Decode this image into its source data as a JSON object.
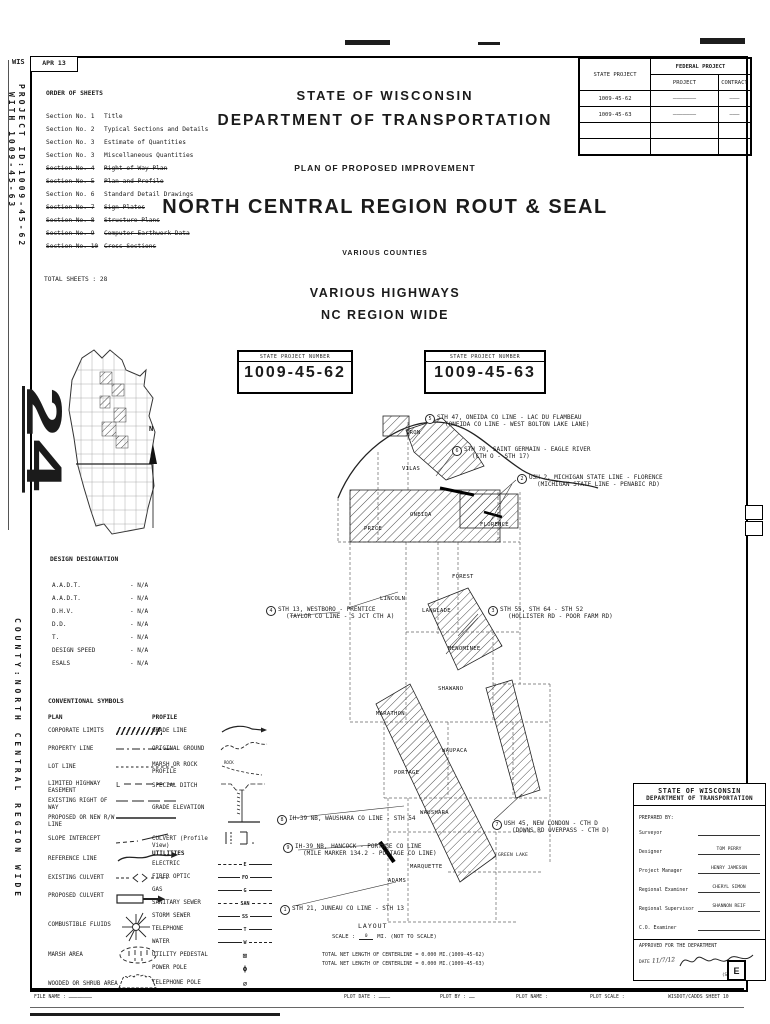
{
  "stamp": {
    "wis": "WIS",
    "date": "APR 13"
  },
  "margin_notes": {
    "project_id_1": "PROJECT ID:1009-45-62",
    "project_id_2": "WITH 1009-45-63",
    "county": "COUNTY:NORTH CENTRAL REGION WIDE"
  },
  "order_of_sheets": {
    "title": "ORDER OF SHEETS",
    "items": [
      {
        "no": "Section No. 1",
        "desc": "Title"
      },
      {
        "no": "Section No. 2",
        "desc": "Typical Sections and Details"
      },
      {
        "no": "Section No. 3",
        "desc": "Estimate of Quantities"
      },
      {
        "no": "Section No. 3",
        "desc": "Miscellaneous Quantities"
      },
      {
        "no": "Section No. 4",
        "desc": "Right of Way Plan"
      },
      {
        "no": "Section No. 5",
        "desc": "Plan and Profile"
      },
      {
        "no": "Section No. 6",
        "desc": "Standard Detail Drawings"
      },
      {
        "no": "Section No. 7",
        "desc": "Sign Plates"
      },
      {
        "no": "Section No. 8",
        "desc": "Structure Plans"
      },
      {
        "no": "Section No. 9",
        "desc": "Computer Earthwork Data"
      },
      {
        "no": "Section No. 10",
        "desc": "Cross Sections"
      }
    ],
    "total": "TOTAL SHEETS : 28"
  },
  "header": {
    "state": "STATE OF WISCONSIN",
    "dept": "DEPARTMENT OF TRANSPORTATION",
    "plan": "PLAN OF PROPOSED IMPROVEMENT",
    "project_title": "NORTH CENTRAL REGION ROUT & SEAL",
    "counties": "VARIOUS COUNTIES",
    "highways": "VARIOUS HIGHWAYS",
    "region": "NC REGION WIDE"
  },
  "project_table": {
    "state_project": "STATE PROJECT",
    "federal_project": "FEDERAL PROJECT",
    "project": "PROJECT",
    "contract": "CONTRACT",
    "rows": [
      {
        "state": "1009-45-62",
        "project": "———————",
        "contract": "———"
      },
      {
        "state": "1009-45-63",
        "project": "———————",
        "contract": "———"
      },
      {
        "state": "",
        "project": "",
        "contract": ""
      },
      {
        "state": "",
        "project": "",
        "contract": ""
      }
    ]
  },
  "project_boxes": [
    {
      "label": "STATE PROJECT NUMBER",
      "number": "1009-45-62"
    },
    {
      "label": "STATE PROJECT NUMBER",
      "number": "1009-45-63"
    }
  ],
  "state_map": {
    "sheet_number": "24",
    "north": "N"
  },
  "design_designation": {
    "title": "DESIGN DESIGNATION",
    "rows": [
      {
        "label": "A.A.D.T.",
        "value": "N/A"
      },
      {
        "label": "A.A.D.T.",
        "value": "N/A"
      },
      {
        "label": "D.H.V.",
        "value": "N/A"
      },
      {
        "label": "D.D.",
        "value": "N/A"
      },
      {
        "label": "T.",
        "value": "N/A"
      },
      {
        "label": "DESIGN SPEED",
        "value": "N/A"
      },
      {
        "label": "ESALS",
        "value": "N/A"
      }
    ]
  },
  "symbols": {
    "title": "CONVENTIONAL SYMBOLS",
    "plan_title": "PLAN",
    "plan": [
      {
        "label": "CORPORATE LIMITS"
      },
      {
        "label": "PROPERTY LINE"
      },
      {
        "label": "LOT LINE"
      },
      {
        "label": "LIMITED HIGHWAY EASEMENT"
      },
      {
        "label": "EXISTING RIGHT OF WAY"
      },
      {
        "label": "PROPOSED OR NEW R/W LINE"
      },
      {
        "label": "SLOPE INTERCEPT"
      },
      {
        "label": "REFERENCE LINE"
      },
      {
        "label": "EXISTING CULVERT"
      },
      {
        "label": "PROPOSED CULVERT",
        "note": "(Box or Pipe)"
      },
      {
        "label": "COMBUSTIBLE FLUIDS"
      },
      {
        "label": "MARSH AREA"
      },
      {
        "label": "WOODED OR SHRUB AREA"
      }
    ],
    "profile_title": "PROFILE",
    "rock_label": "ROCK",
    "profile": [
      {
        "label": "GRADE LINE"
      },
      {
        "label": "ORIGINAL GROUND"
      },
      {
        "label": "MARSH OR ROCK PROFILE",
        "note": "(To be noted as such)"
      },
      {
        "label": "SPECIAL DITCH"
      },
      {
        "label": "GRADE ELEVATION"
      },
      {
        "label": "CULVERT (Profile View)"
      }
    ],
    "utilities_title": "UTILITIES",
    "utilities": [
      {
        "label": "ELECTRIC",
        "code": "E"
      },
      {
        "label": "FIBER OPTIC",
        "code": "FO"
      },
      {
        "label": "GAS",
        "code": "G"
      },
      {
        "label": "SANITARY SEWER",
        "code": "SAN"
      },
      {
        "label": "STORM SEWER",
        "code": "SS"
      },
      {
        "label": "TELEPHONE",
        "code": "T"
      },
      {
        "label": "WATER",
        "code": "W"
      },
      {
        "label": "UTILITY PEDESTAL",
        "code": "⊠"
      },
      {
        "label": "POWER POLE",
        "code": "ϕ"
      },
      {
        "label": "TELEPHONE POLE",
        "code": "∅"
      }
    ]
  },
  "map": {
    "counties": [
      "IRON",
      "VILAS",
      "PRICE",
      "ONEIDA",
      "FLORENCE",
      "FOREST",
      "LINCOLN",
      "LANGLADE",
      "MENOMINEE",
      "SHAWANO",
      "MARATHON",
      "WAUPACA",
      "PORTAGE",
      "WAUSHARA",
      "GREEN LAKE",
      "MARQUETTE",
      "ADAMS"
    ],
    "callouts": [
      {
        "num": "1",
        "line1": "STH 21, JUNEAU CO LINE - STH 13",
        "line2": ""
      },
      {
        "num": "2",
        "line1": "USH 2, MICHIGAN STATE LINE - FLORENCE",
        "line2": "(MICHIGAN STATE LINE - PENABIC RD)"
      },
      {
        "num": "3",
        "line1": "STH 55, STH 64 - STH 52",
        "line2": "(HOLLISTER RD - POOR FARM RD)"
      },
      {
        "num": "4",
        "line1": "STH 13, WESTBORO - PRENTICE",
        "line2": "(TAYLOR CO LINE - S JCT CTH A)"
      },
      {
        "num": "5",
        "line1": "STH 47, ONEIDA CO LINE - LAC DU FLAMBEAU",
        "line2": "(ONEIDA CO LINE - WEST BOLTON LAKE LANE)"
      },
      {
        "num": "6",
        "line1": "STH 70, SAINT GERMAIN - EAGLE RIVER",
        "line2": "(CTH O - STH 17)"
      },
      {
        "num": "7",
        "line1": "USH 45, NEW LONDON - CTH D",
        "line2": "(DOWNS RD OVERPASS - CTH D)"
      },
      {
        "num": "8",
        "line1": "IH-39 NB, WAUSHARA CO LINE - STH 54",
        "line2": ""
      },
      {
        "num": "9",
        "line1": "IH-39 NB, HANCOCK - PORTAGE CO LINE",
        "line2": "(MILE MARKER 134.2 - PORTAGE CO LINE)"
      }
    ]
  },
  "layout_block": {
    "title": "LAYOUT",
    "scale_label": "SCALE :",
    "scale_zero": "0",
    "scale_note": "MI. (NOT TO SCALE)",
    "total_1": "TOTAL NET LENGTH OF CENTERLINE = 0.000 MI.(1009-45-62)",
    "total_2": "TOTAL NET LENGTH OF CENTERLINE = 0.000 MI.(1009-45-63)"
  },
  "prepared_box": {
    "state": "STATE OF WISCONSIN",
    "dept": "DEPARTMENT OF TRANSPORTATION",
    "prepared_by": "PREPARED BY:",
    "rows": [
      {
        "label": "Surveyor",
        "value": ""
      },
      {
        "label": "Designer",
        "value": "TOM PERRY"
      },
      {
        "label": "Project Manager",
        "value": "HENRY JAMESON"
      },
      {
        "label": "Regional Examiner",
        "value": "CHERYL SIMON"
      },
      {
        "label": "Regional Supervisor",
        "value": "SHANNON REIF"
      },
      {
        "label": "C.O. Examiner",
        "value": ""
      }
    ],
    "approved": "APPROVED FOR THE DEPARTMENT",
    "date_label": "DATE",
    "date_value": "11/7/12",
    "signed_note": "(Signed)",
    "revision_letter": "E"
  },
  "footer": {
    "file_name": "FILE NAME : ……………………",
    "plot_date": "PLOT DATE : …………",
    "plot_by": "PLOT BY : ……",
    "plot_name": "PLOT NAME :",
    "plot_scale": "PLOT SCALE :",
    "sheet_ref": "WISDOT/CADDS SHEET 10"
  }
}
